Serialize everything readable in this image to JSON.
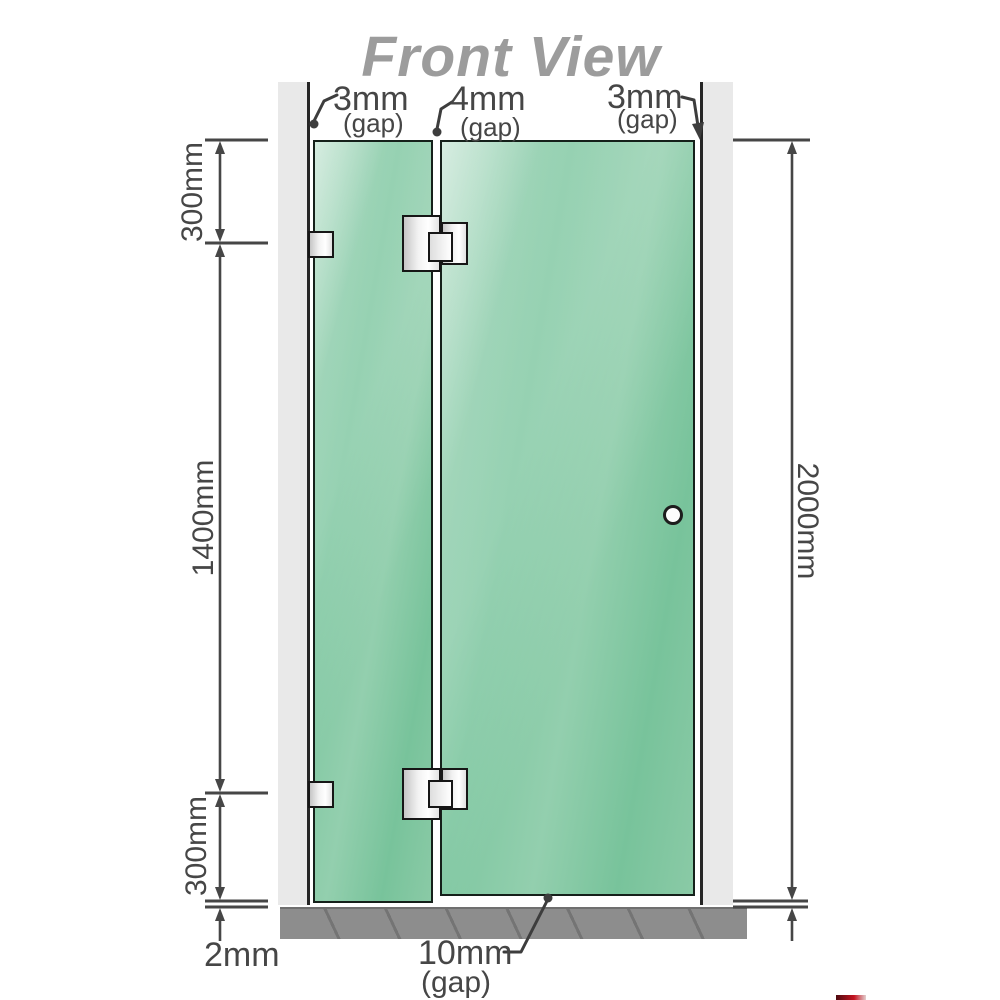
{
  "title": "Front View",
  "annotations": {
    "top_left_gap": {
      "value": "3mm",
      "suffix": "(gap)"
    },
    "top_middle_gap": {
      "value": "4mm",
      "suffix": "(gap)"
    },
    "top_right_gap": {
      "value": "3mm",
      "suffix": "(gap)"
    },
    "bottom_gap": {
      "value": "10mm",
      "suffix": "(gap)"
    },
    "floor_offset": {
      "value": "2mm"
    }
  },
  "dimensions": {
    "left_top": "300mm",
    "left_middle": "1400mm",
    "left_bottom": "300mm",
    "right_total": "2000mm"
  },
  "colors": {
    "glass": "#7cc7a0",
    "glass_outline": "#15201a",
    "wall": "#e9e9e9",
    "wall_edge": "#262626",
    "floor": "#8d8d8d",
    "line": "#464646",
    "title": "#9c9c9c",
    "hardware_outline": "#161616"
  }
}
